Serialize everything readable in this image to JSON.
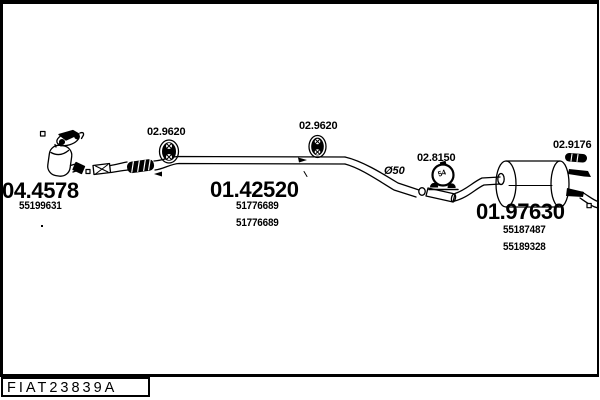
{
  "colors": {
    "ink": "#000000",
    "paper": "#ffffff"
  },
  "diagram": {
    "pipe_diameter_label": "Ø50",
    "clamp_inner_label": "54",
    "accessories": {
      "hanger_left_ref": "02.9620",
      "hanger_mid_ref": "02.9620",
      "clamp_ref": "02.8150",
      "rear_hanger_ref": "02.9176"
    },
    "parts": {
      "catalyst": {
        "number": "04.4578",
        "oe1": "55199631"
      },
      "centre_pipe": {
        "number": "01.42520",
        "oe1": "51776689",
        "oe2": "51776689"
      },
      "rear_silencer": {
        "number": "01.97630",
        "oe1": "55187487",
        "oe2": "55189328"
      }
    }
  },
  "footer": {
    "drawing_code": "FIAT23839A"
  }
}
